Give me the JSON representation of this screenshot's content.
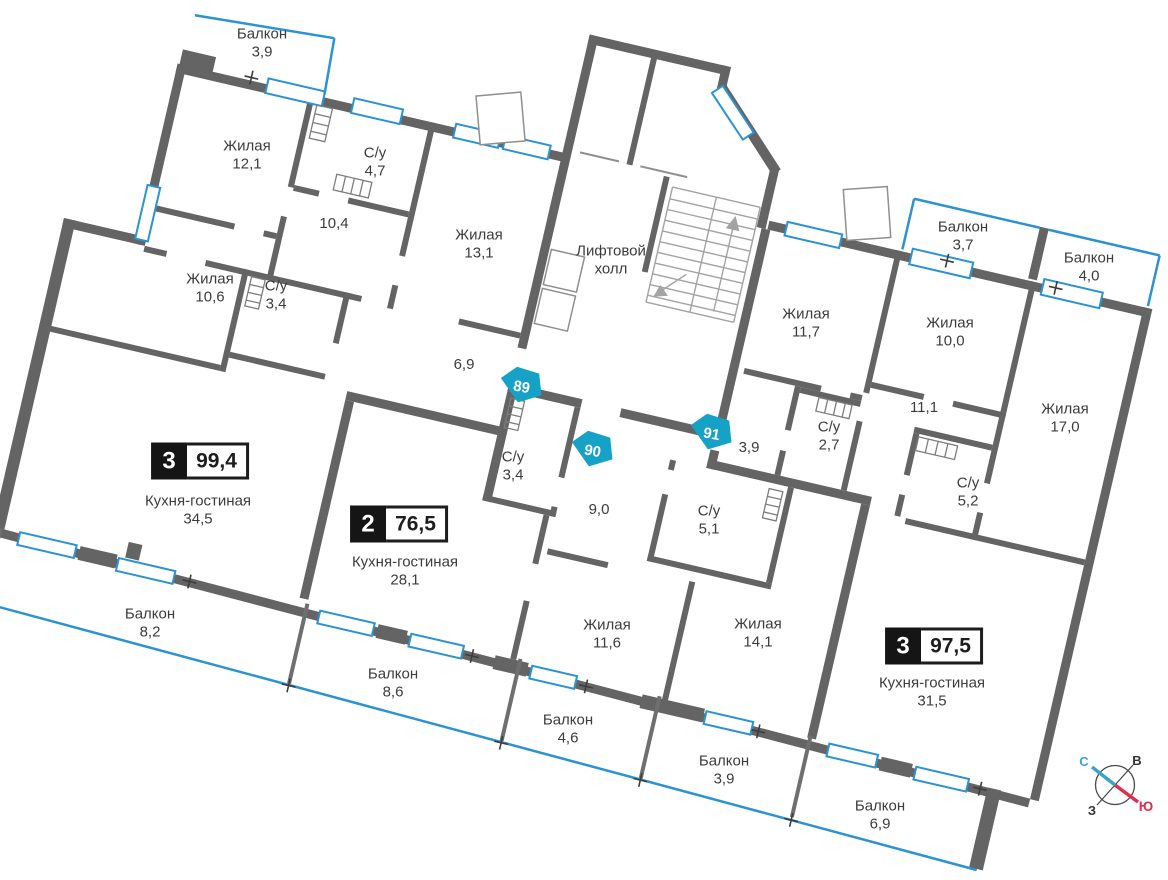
{
  "title": "Поэтажный план — квартиры 89, 90, 91",
  "colors": {
    "wall": "#646464",
    "partition": "#6f6f6f",
    "window_blue": "#2b93d2",
    "unit_marker_teal": "#16a2c6",
    "badge_black": "#151515",
    "text": "#3c3c3c",
    "stairs_gray": "#a3a3a3",
    "compass_north": "#3ea2c9",
    "compass_south": "#e02e4e"
  },
  "common": {
    "lift_hall": {
      "line1": "Лифтовой",
      "line2": "холл"
    }
  },
  "apartments": {
    "apt89": {
      "unit": "89",
      "rooms_count": "3",
      "total_area": "99,4",
      "rooms": {
        "balk39t": {
          "name": "Балкон",
          "area": "3,9"
        },
        "zh121": {
          "name": "Жилая",
          "area": "12,1"
        },
        "su47": {
          "name": "С/у",
          "area": "4,7"
        },
        "cor104": {
          "area": "10,4"
        },
        "zh131": {
          "name": "Жилая",
          "area": "13,1"
        },
        "zh106": {
          "name": "Жилая",
          "area": "10,6"
        },
        "su34": {
          "name": "С/у",
          "area": "3,4"
        },
        "cor69": {
          "area": "6,9"
        },
        "kg345": {
          "name": "Кухня-гостиная",
          "area": "34,5"
        },
        "balk82": {
          "name": "Балкон",
          "area": "8,2"
        }
      }
    },
    "apt90": {
      "unit": "90",
      "rooms_count": "2",
      "total_area": "76,5",
      "rooms": {
        "kg281": {
          "name": "Кухня-гостиная",
          "area": "28,1"
        },
        "su34": {
          "name": "С/у",
          "area": "3,4"
        },
        "cor9": {
          "area": "9,0"
        },
        "su51": {
          "name": "С/у",
          "area": "5,1"
        },
        "zh116": {
          "name": "Жилая",
          "area": "11,6"
        },
        "zh141": {
          "name": "Жилая",
          "area": "14,1"
        },
        "balk86": {
          "name": "Балкон",
          "area": "8,6"
        },
        "balk46": {
          "name": "Балкон",
          "area": "4,6"
        },
        "balk39": {
          "name": "Балкон",
          "area": "3,9"
        }
      }
    },
    "apt91": {
      "unit": "91",
      "rooms_count": "3",
      "total_area": "97,5",
      "rooms": {
        "zh117": {
          "name": "Жилая",
          "area": "11,7"
        },
        "balk37": {
          "name": "Балкон",
          "area": "3,7"
        },
        "balk40": {
          "name": "Балкон",
          "area": "4,0"
        },
        "zh100": {
          "name": "Жилая",
          "area": "10,0"
        },
        "zh170": {
          "name": "Жилая",
          "area": "17,0"
        },
        "cor111": {
          "area": "11,1"
        },
        "su27": {
          "name": "С/у",
          "area": "2,7"
        },
        "cor39": {
          "area": "3,9"
        },
        "su52": {
          "name": "С/у",
          "area": "5,2"
        },
        "kg315": {
          "name": "Кухня-гостиная",
          "area": "31,5"
        },
        "balk69": {
          "name": "Балкон",
          "area": "6,9"
        }
      }
    }
  },
  "compass": {
    "north": "С",
    "east": "В",
    "west": "З",
    "south": "Ю"
  }
}
